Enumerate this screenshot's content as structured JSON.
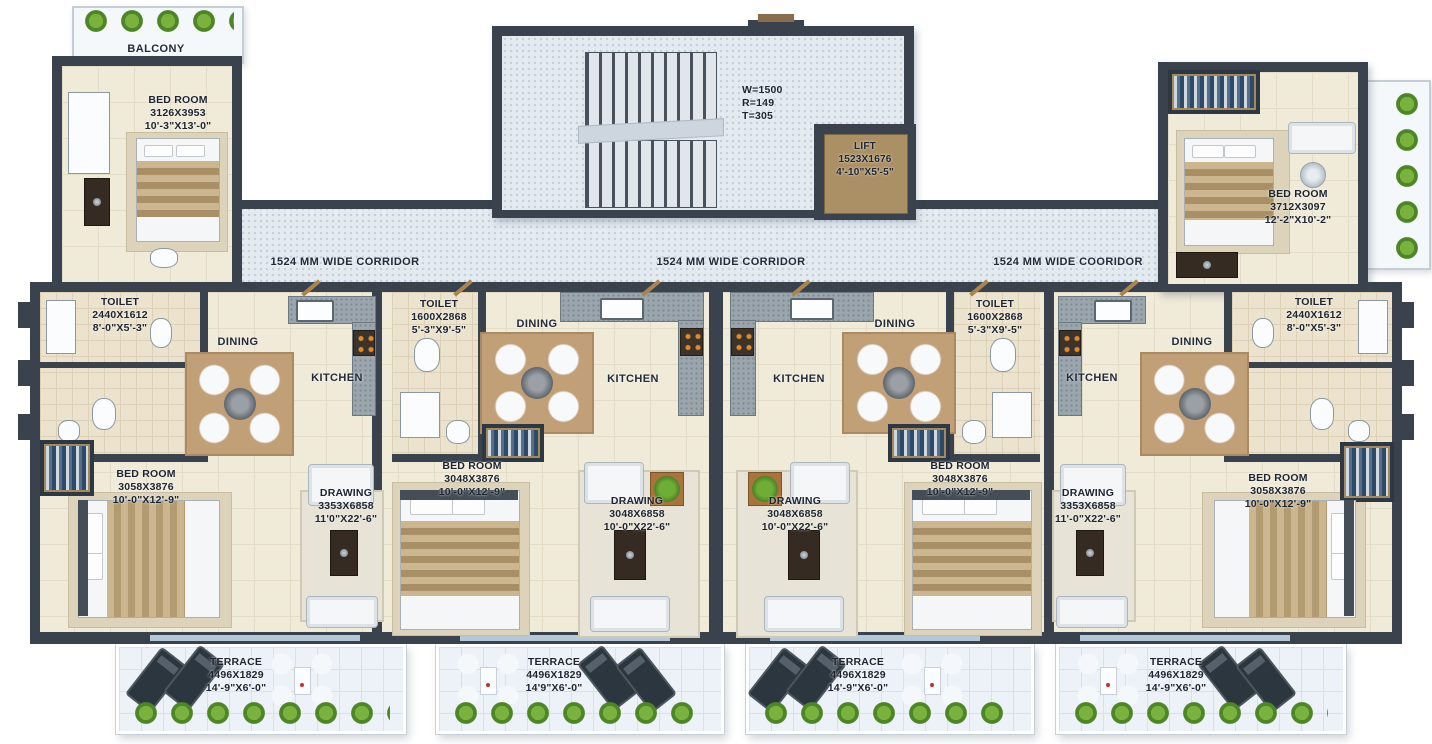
{
  "corridors": {
    "left": "1524 MM WIDE CORRIDOR",
    "center": "1524 MM WIDE CORRIDOR",
    "right": "1524 MM WIDE COORIDOR"
  },
  "stairwell": {
    "line1": "W=1500",
    "line2": "R=149",
    "line3": "T=305"
  },
  "lift": {
    "line1": "LIFT",
    "line2": "1523X1676",
    "line3": "4'-10\"X5'-5\""
  },
  "balcony_top_left": {
    "label": "BALCONY"
  },
  "bedroom_top_left": {
    "line1": "BED ROOM",
    "line2": "3126X3953",
    "line3": "10'-3\"X13'-0\""
  },
  "bedroom_top_right": {
    "line1": "BED ROOM",
    "line2": "3712X3097",
    "line3": "12'-2\"X10'-2\""
  },
  "unit1": {
    "toilet": {
      "line1": "TOILET",
      "line2": "2440X1612",
      "line3": "8'-0\"X5'-3\""
    },
    "dining": {
      "label": "DINING"
    },
    "kitchen": {
      "label": "KITCHEN"
    },
    "bedroom": {
      "line1": "BED ROOM",
      "line2": "3058X3876",
      "line3": "10'-0\"X12'-9\""
    },
    "drawing": {
      "line1": "DRAWING",
      "line2": "3353X6858",
      "line3": "11'0\"X22'-6\""
    }
  },
  "unit2": {
    "toilet": {
      "line1": "TOILET",
      "line2": "1600X2868",
      "line3": "5'-3\"X9'-5\""
    },
    "dining": {
      "label": "DINING"
    },
    "kitchen": {
      "label": "KITCHEN"
    },
    "bedroom": {
      "line1": "BED ROOM",
      "line2": "3048X3876",
      "line3": "10'-0\"X12'-9\""
    },
    "drawing": {
      "line1": "DRAWING",
      "line2": "3048X6858",
      "line3": "10'-0\"X22'-6\""
    }
  },
  "unit3": {
    "toilet": {
      "line1": "TOILET",
      "line2": "1600X2868",
      "line3": "5'-3\"X9'-5\""
    },
    "dining": {
      "label": "DINING"
    },
    "kitchen": {
      "label": "KITCHEN"
    },
    "bedroom": {
      "line1": "BED ROOM",
      "line2": "3048X3876",
      "line3": "10'-0\"X12'-9\""
    },
    "drawing": {
      "line1": "DRAWING",
      "line2": "3048X6858",
      "line3": "10'-0\"X22'-6\""
    }
  },
  "unit4": {
    "toilet": {
      "line1": "TOILET",
      "line2": "2440X1612",
      "line3": "8'-0\"X5'-3\""
    },
    "dining": {
      "label": "DINING"
    },
    "kitchen": {
      "label": "KITCHEN"
    },
    "bedroom": {
      "line1": "BED ROOM",
      "line2": "3058X3876",
      "line3": "10'-0\"X12'-9\""
    },
    "drawing": {
      "line1": "DRAWING",
      "line2": "3353X6858",
      "line3": "11'-0\"X22'-6\""
    }
  },
  "terraces": [
    {
      "line1": "TERRACE",
      "line2": "4496X1829",
      "line3": "14'-9\"X6'-0\""
    },
    {
      "line1": "TERRACE",
      "line2": "4496X1829",
      "line3": "14'9\"X6'-0\""
    },
    {
      "line1": "TERRACE",
      "line2": "4496X1829",
      "line3": "14'-9\"X6'-0\""
    },
    {
      "line1": "TERRACE",
      "line2": "4496X1829",
      "line3": "14'-9\"X6'-0\""
    }
  ],
  "colors": {
    "wall": "#39424d",
    "floor": "#f0ead9",
    "corridor": "#e3eaf0",
    "lift": "#ab9065",
    "plant": "#7ab23e",
    "label_text": "#1d242f"
  }
}
